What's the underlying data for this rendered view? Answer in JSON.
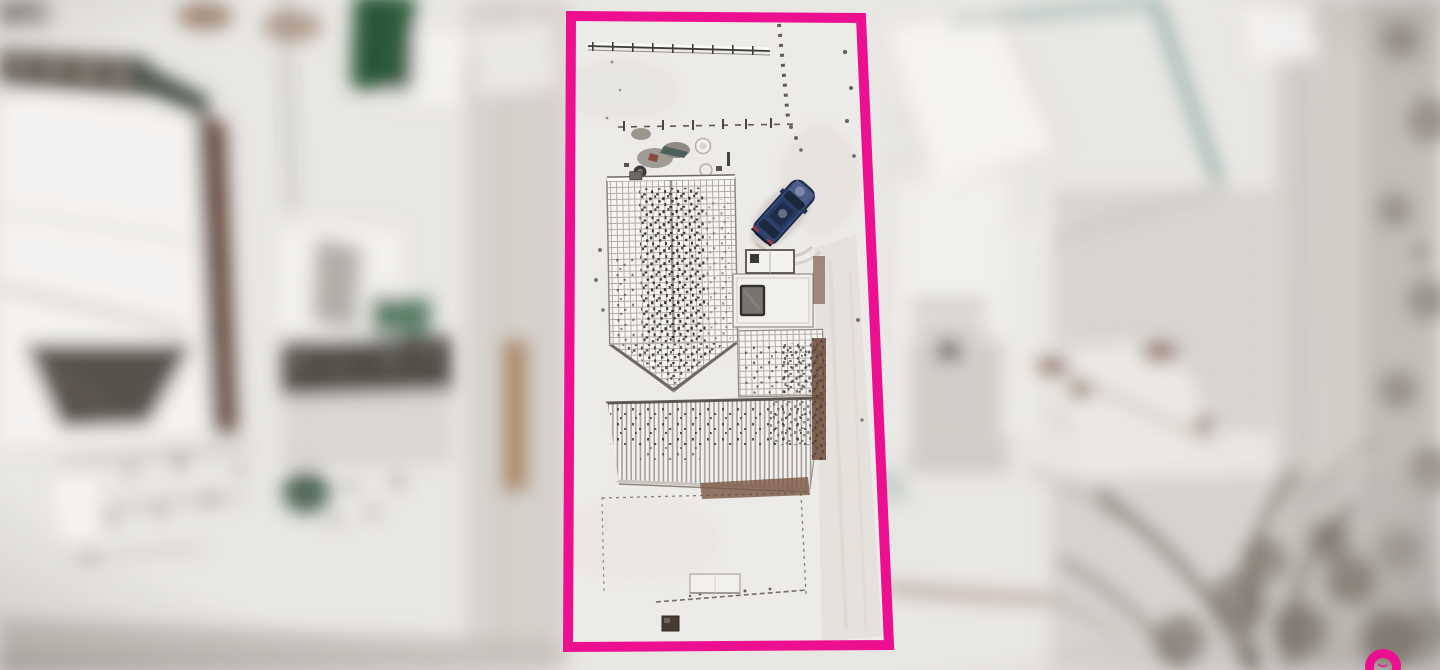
{
  "meta": {
    "description": "Aerial winter drone photograph of a residential plot; surroundings are blurred while the highlighted parcel inside a magenta boundary rectangle is in sharp focus",
    "season": "winter, snow cover",
    "no_visible_text": true
  },
  "overlay": {
    "boundary_shape": "rectangle",
    "boundary_stroke_px": 10,
    "watermark_shape": "partial-ring",
    "watermark_position": "bottom-right"
  },
  "colors": {
    "boundary_pink": "#EC1090",
    "snow": "#E9E7E4",
    "snow_inner": "#EDEBE8",
    "road": "#C9C5C0",
    "dark_roof": "#57534C",
    "lawn_green": "#2F5E3C",
    "fence_teal": "#2E6B60",
    "hedge_brown": "#6E4C3B",
    "wall_brown": "#7A4A3C",
    "tree_gray": "#6B6258",
    "car_blue": "#2E4470",
    "car_glass": "#1B2738",
    "taillight_red": "#9E3946",
    "skylight_gray": "#77756E"
  },
  "scene": {
    "highlighted_property": {
      "house": "L-shaped house, snow-dusted tiled gable roof with ribbed lower roof and flat annex with skylight",
      "car": "dark blue estate car parked at an angle beside the house",
      "yard": "snowy garden with top fence line, dashed boundary, object cluster, shed box and small dark hatch"
    },
    "surroundings": [
      "large neighbouring building with white gabled roof (left)",
      "house with striped roof and green roof patch (centre-left)",
      "green lawn strip (top-left)",
      "teal garden fence lines (top-right)",
      "building with window rows and speckled orchard (right)",
      "street with tyre tracks (far right and bottom)",
      "bare winter trees (bottom-right)"
    ]
  }
}
